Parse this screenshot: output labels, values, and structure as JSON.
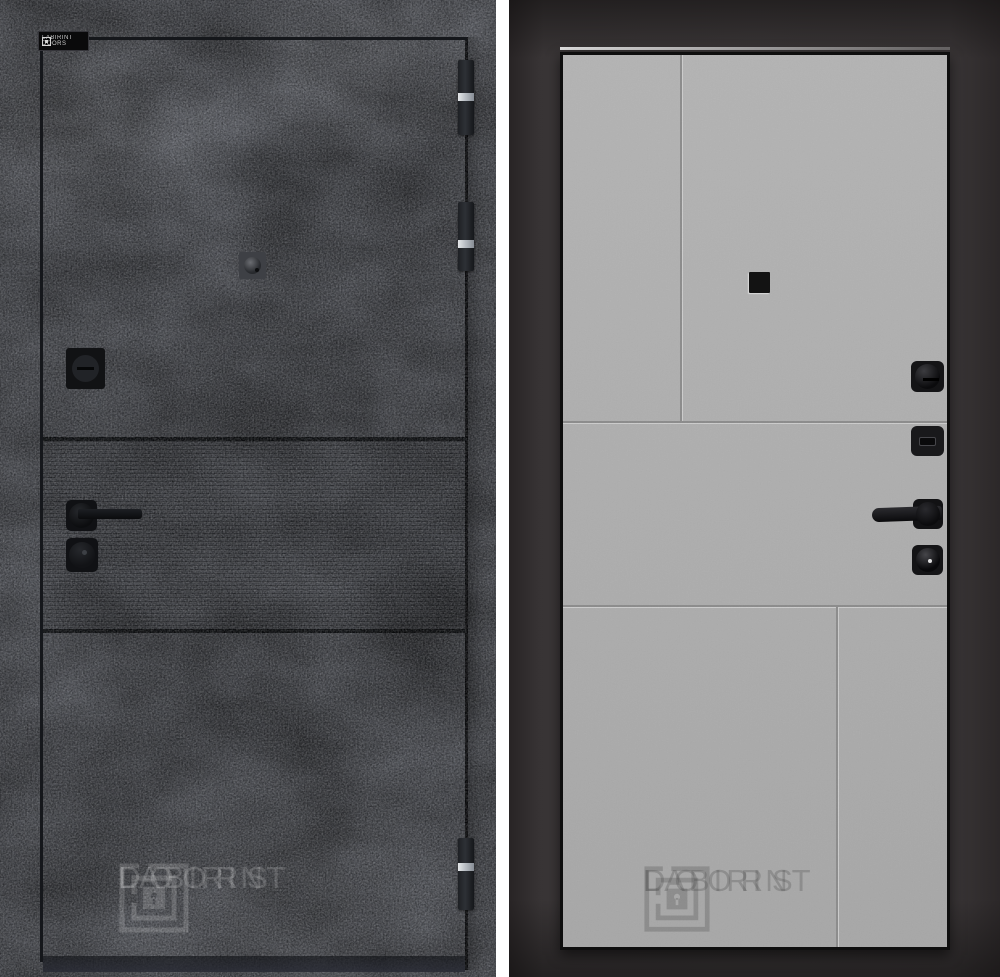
{
  "meta": {
    "title": "LABIRINT DOORS entrance door — exterior and interior views",
    "panel_left": "exterior-concrete-dark",
    "panel_right": "interior-grey-panelled"
  },
  "badge": {
    "line1": "LABIRINT",
    "line2": "DOORS"
  },
  "watermark": {
    "line1": "LABIRINT",
    "line2": "DOORS"
  },
  "left_panel": {
    "texture": "dark concrete",
    "hardware": [
      "peephole",
      "deadbolt-turn",
      "lever-handle",
      "cylinder-lock"
    ],
    "hinge_count": 3
  },
  "right_panel": {
    "finish": "light grey flat panels",
    "hardware": [
      "peephole",
      "thumb-turn",
      "escutcheon",
      "lever-handle",
      "cylinder-lock"
    ]
  },
  "colors": {
    "concrete": "#6f727a",
    "ribbed_tint": "#60636b",
    "leaf_grey": "#b2b2b2",
    "frame_charcoal": "#393536",
    "hardware_black": "#131316",
    "hinge_chrome": "#d9dbde",
    "background": "#ffffff"
  }
}
